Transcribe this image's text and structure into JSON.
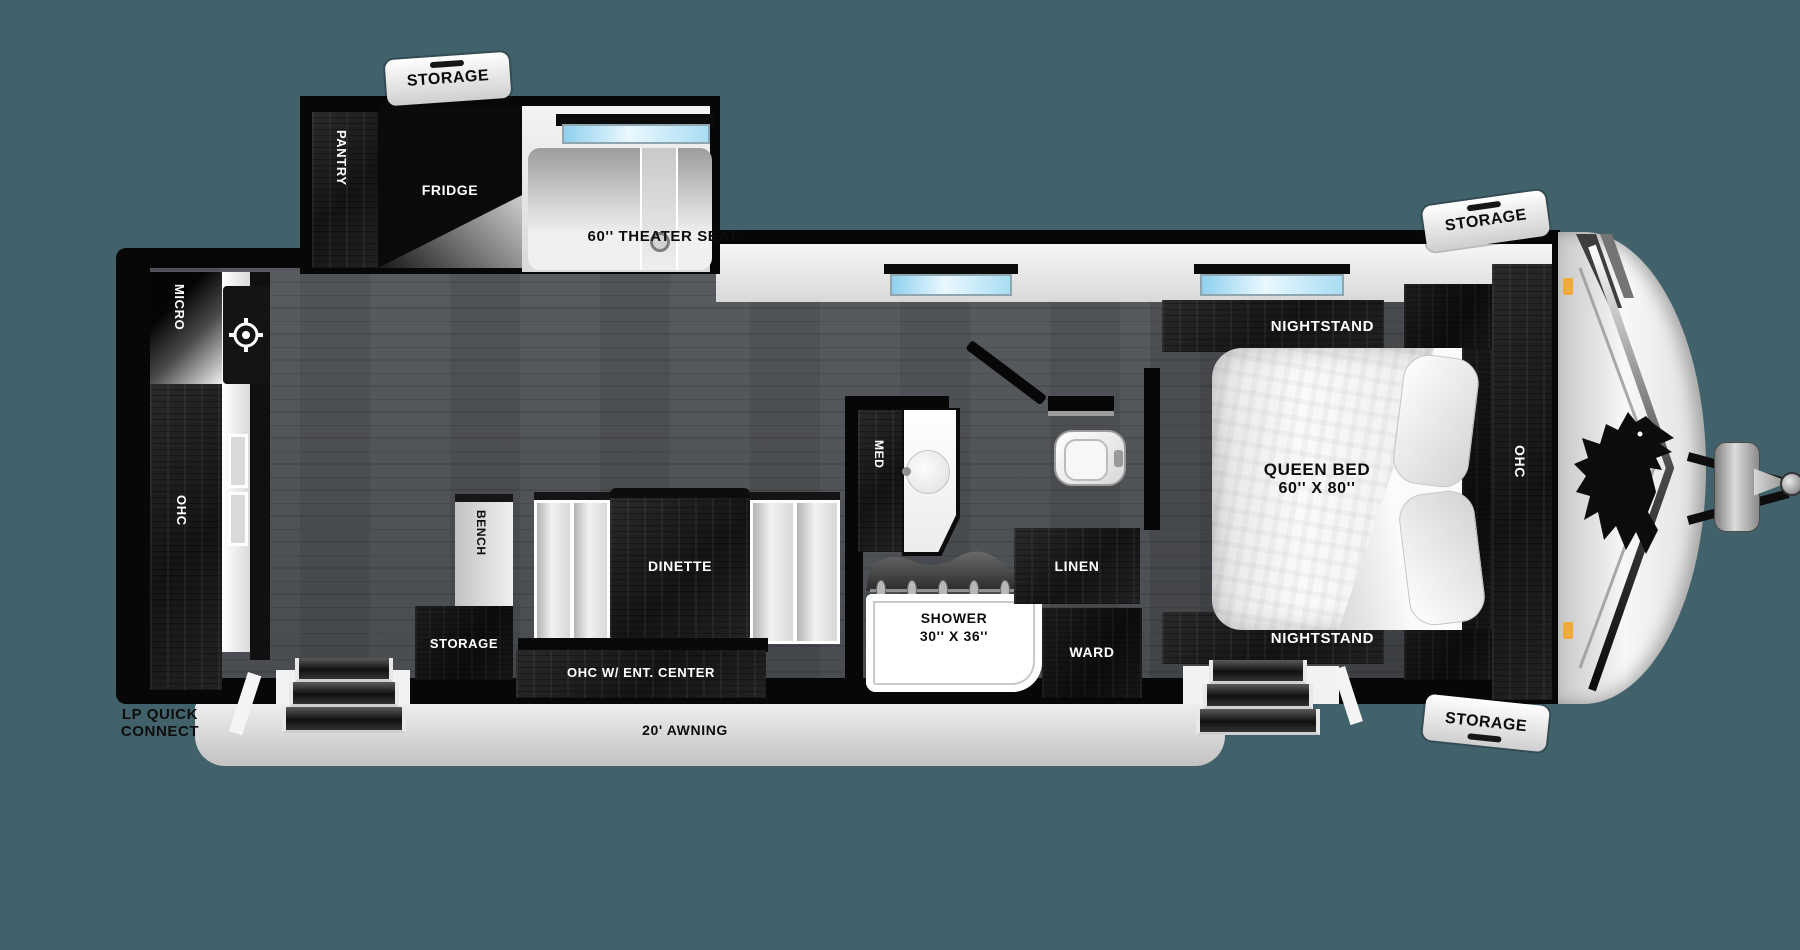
{
  "canvas": {
    "width": 1800,
    "height": 950,
    "background": "#42626B"
  },
  "colors": {
    "body_outline": "#070707",
    "wall_white": "#F2F2F2",
    "floor_wood": "#54575B",
    "cabinet_wood": "#1B1B1B",
    "window_glass": "#A9DDF3",
    "marker_orange": "#F2A93B",
    "awning_gray": "#D9D9D9"
  },
  "labels": {
    "storage_tag": "STORAGE",
    "pantry": "PANTRY",
    "fridge": "FRIDGE",
    "theater_seat": "60'' THEATER SEAT",
    "micro": "MICRO",
    "ohc_rear": "OHC",
    "bench": "BENCH",
    "dinette": "DINETTE",
    "storage_compartment": "STORAGE",
    "ohc_ent_center": "OHC W/ ENT. CENTER",
    "med": "MED",
    "shower_line1": "SHOWER",
    "shower_line2": "30'' X 36''",
    "linen": "LINEN",
    "ward": "WARD",
    "nightstand_top": "NIGHTSTAND",
    "nightstand_bottom": "NIGHTSTAND",
    "queen_bed_line1": "QUEEN BED",
    "queen_bed_line2": "60'' X 80''",
    "ohc_bedroom": "OHC",
    "lp_quick_connect_line1": "LP QUICK",
    "lp_quick_connect_line2": "CONNECT",
    "awning": "20' AWNING"
  }
}
